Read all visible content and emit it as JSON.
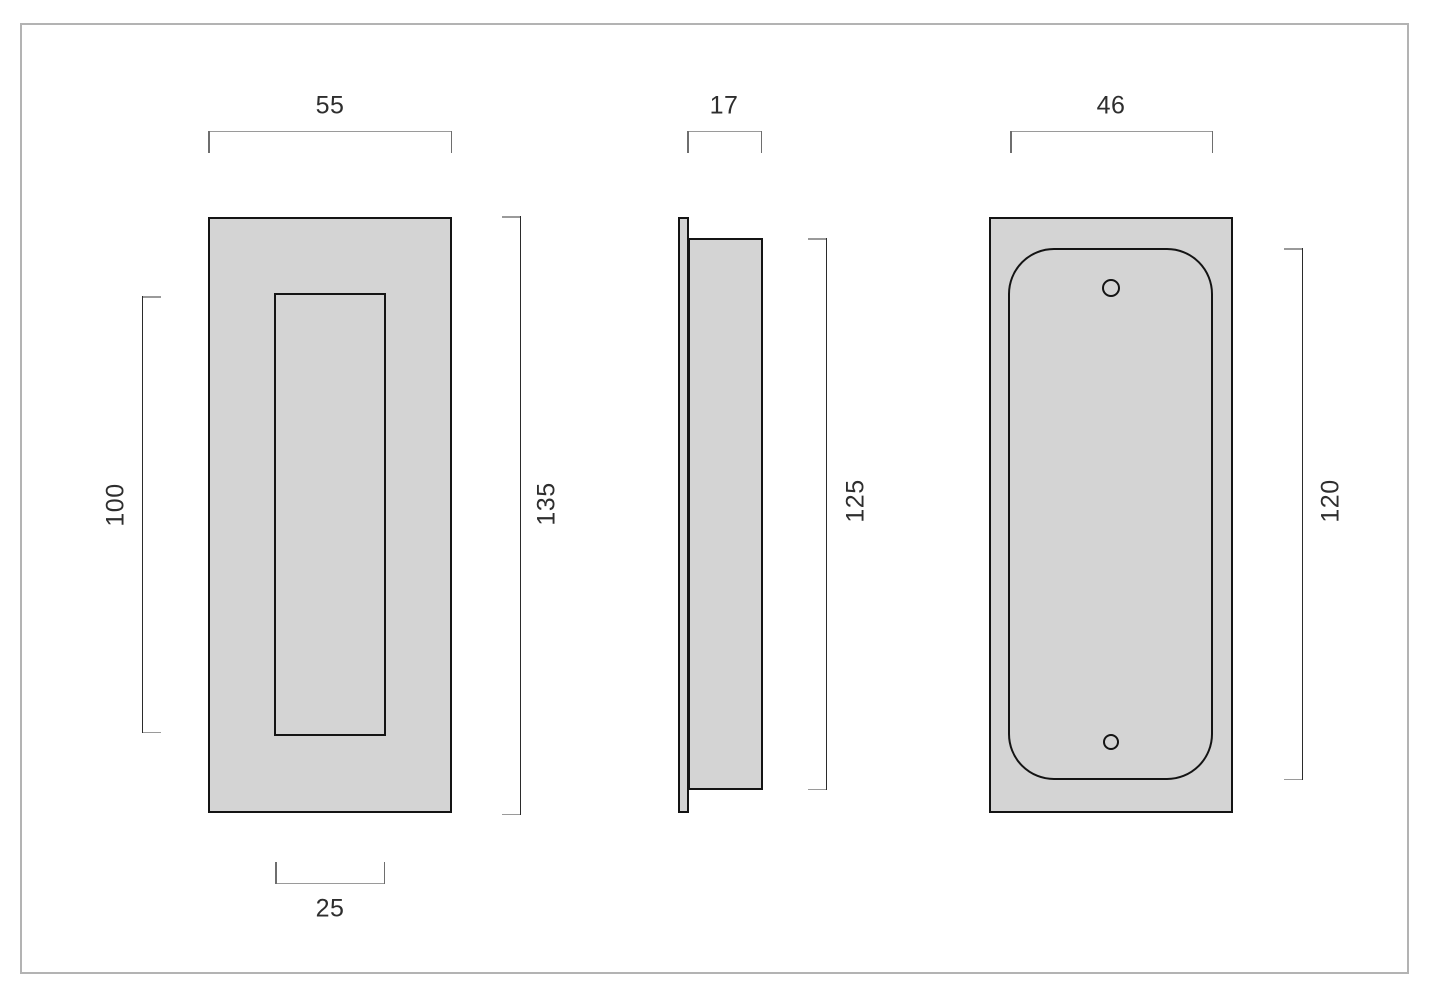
{
  "dimensions": {
    "front_width": "55",
    "front_height": "135",
    "front_recess_width": "25",
    "front_recess_height": "100",
    "side_depth": "17",
    "side_body_height": "125",
    "back_recess_width": "46",
    "back_recess_height": "120"
  },
  "colors": {
    "fill": "#d4d4d4",
    "outline": "#141414",
    "dim_line": "#9a9a9a",
    "dim_tick": "#6e6e6e",
    "dim_span": "#2b2b2b",
    "text": "#2e2e2e",
    "frame": "#b3b3b3",
    "bg": "#ffffff"
  }
}
